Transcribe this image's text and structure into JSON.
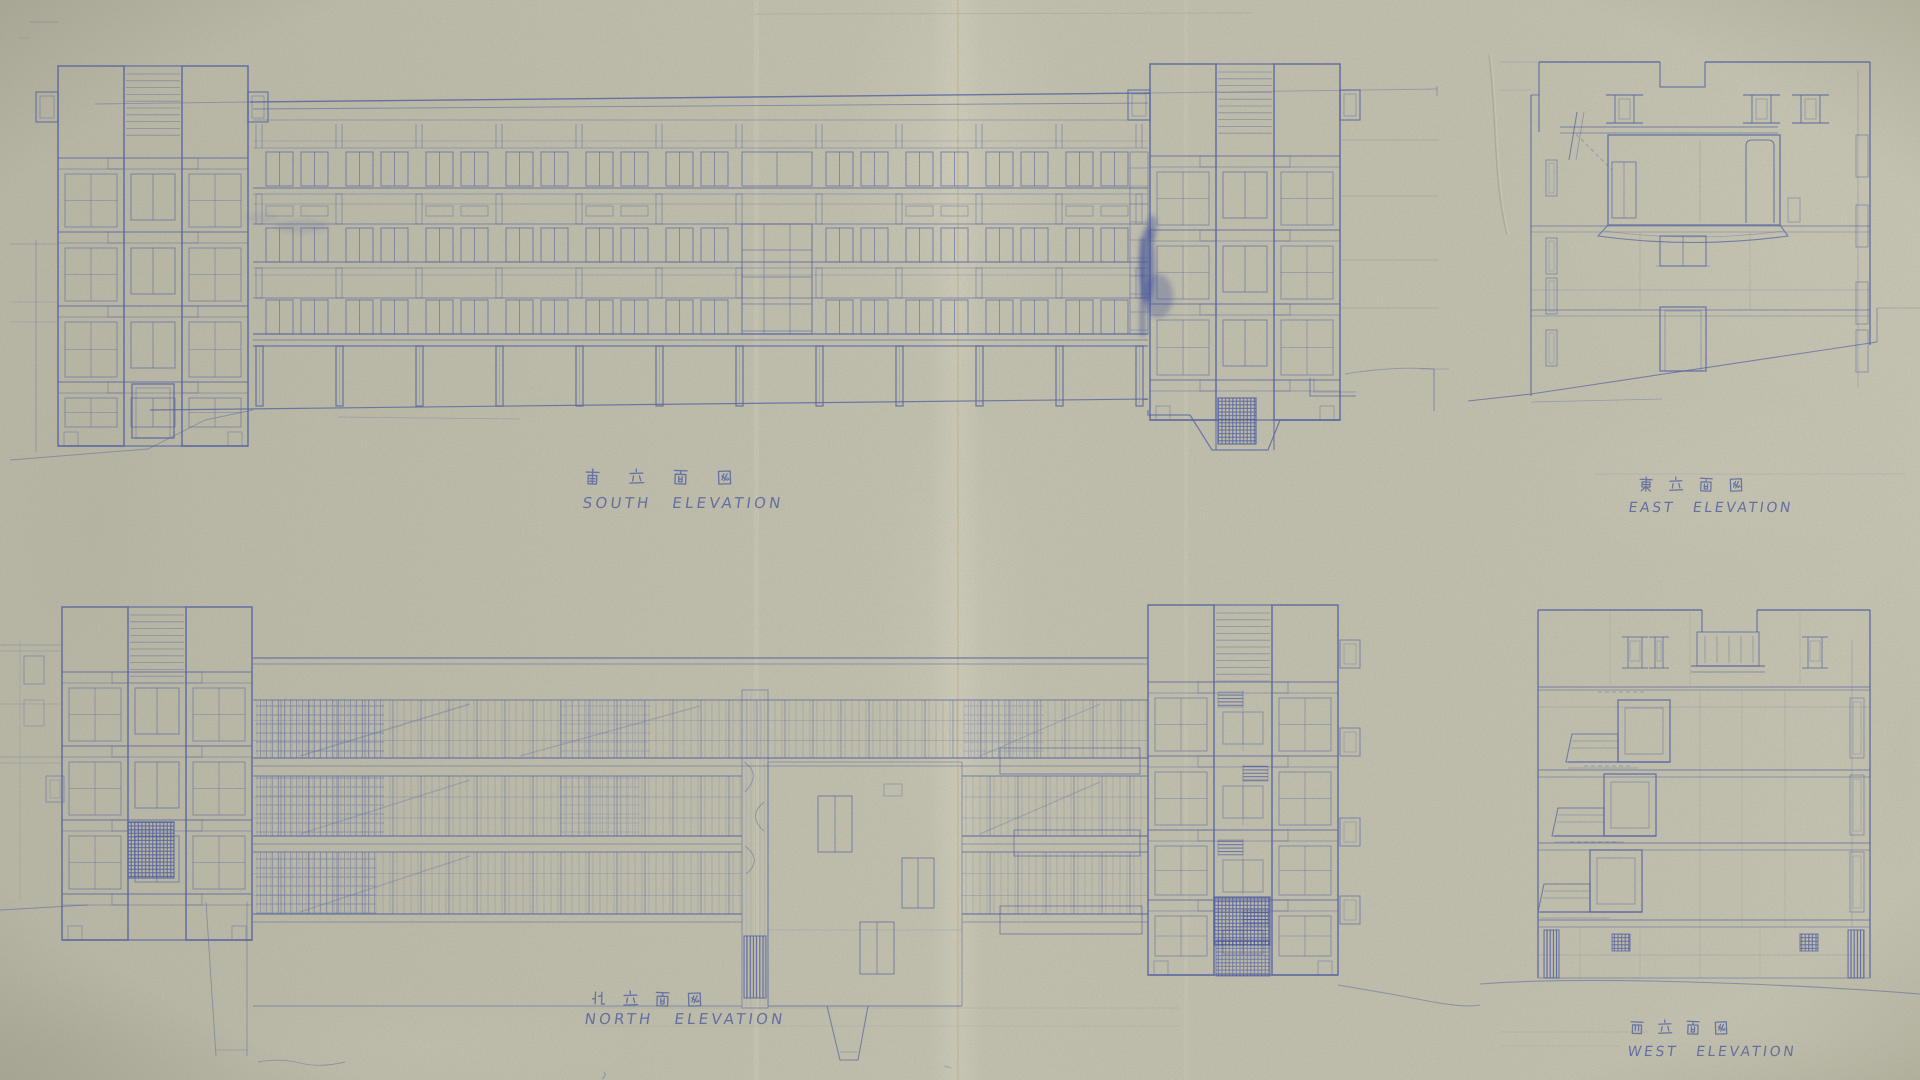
{
  "sheet": {
    "kind": "architectural elevation blueprint (aged paper, blue ink)",
    "paper_color": "#cbc8ae",
    "paper_highlight": "#ded9bf",
    "paper_shadow": "#a8a58b",
    "fold_color": "#c9b98e",
    "ink_color": "#5060a2",
    "ink_strong": "#32439b"
  },
  "drawings": [
    {
      "id": "south",
      "jp_label": "南 立 面 図",
      "en_label": "SOUTH ELEVATION"
    },
    {
      "id": "east",
      "jp_label": "東 立 面 図",
      "en_label": "EAST ELEVATION"
    },
    {
      "id": "north",
      "jp_label": "北 立 面 図",
      "en_label": "NORTH ELEVATION"
    },
    {
      "id": "west",
      "jp_label": "西 立 面 図",
      "en_label": "WEST ELEVATION"
    }
  ]
}
